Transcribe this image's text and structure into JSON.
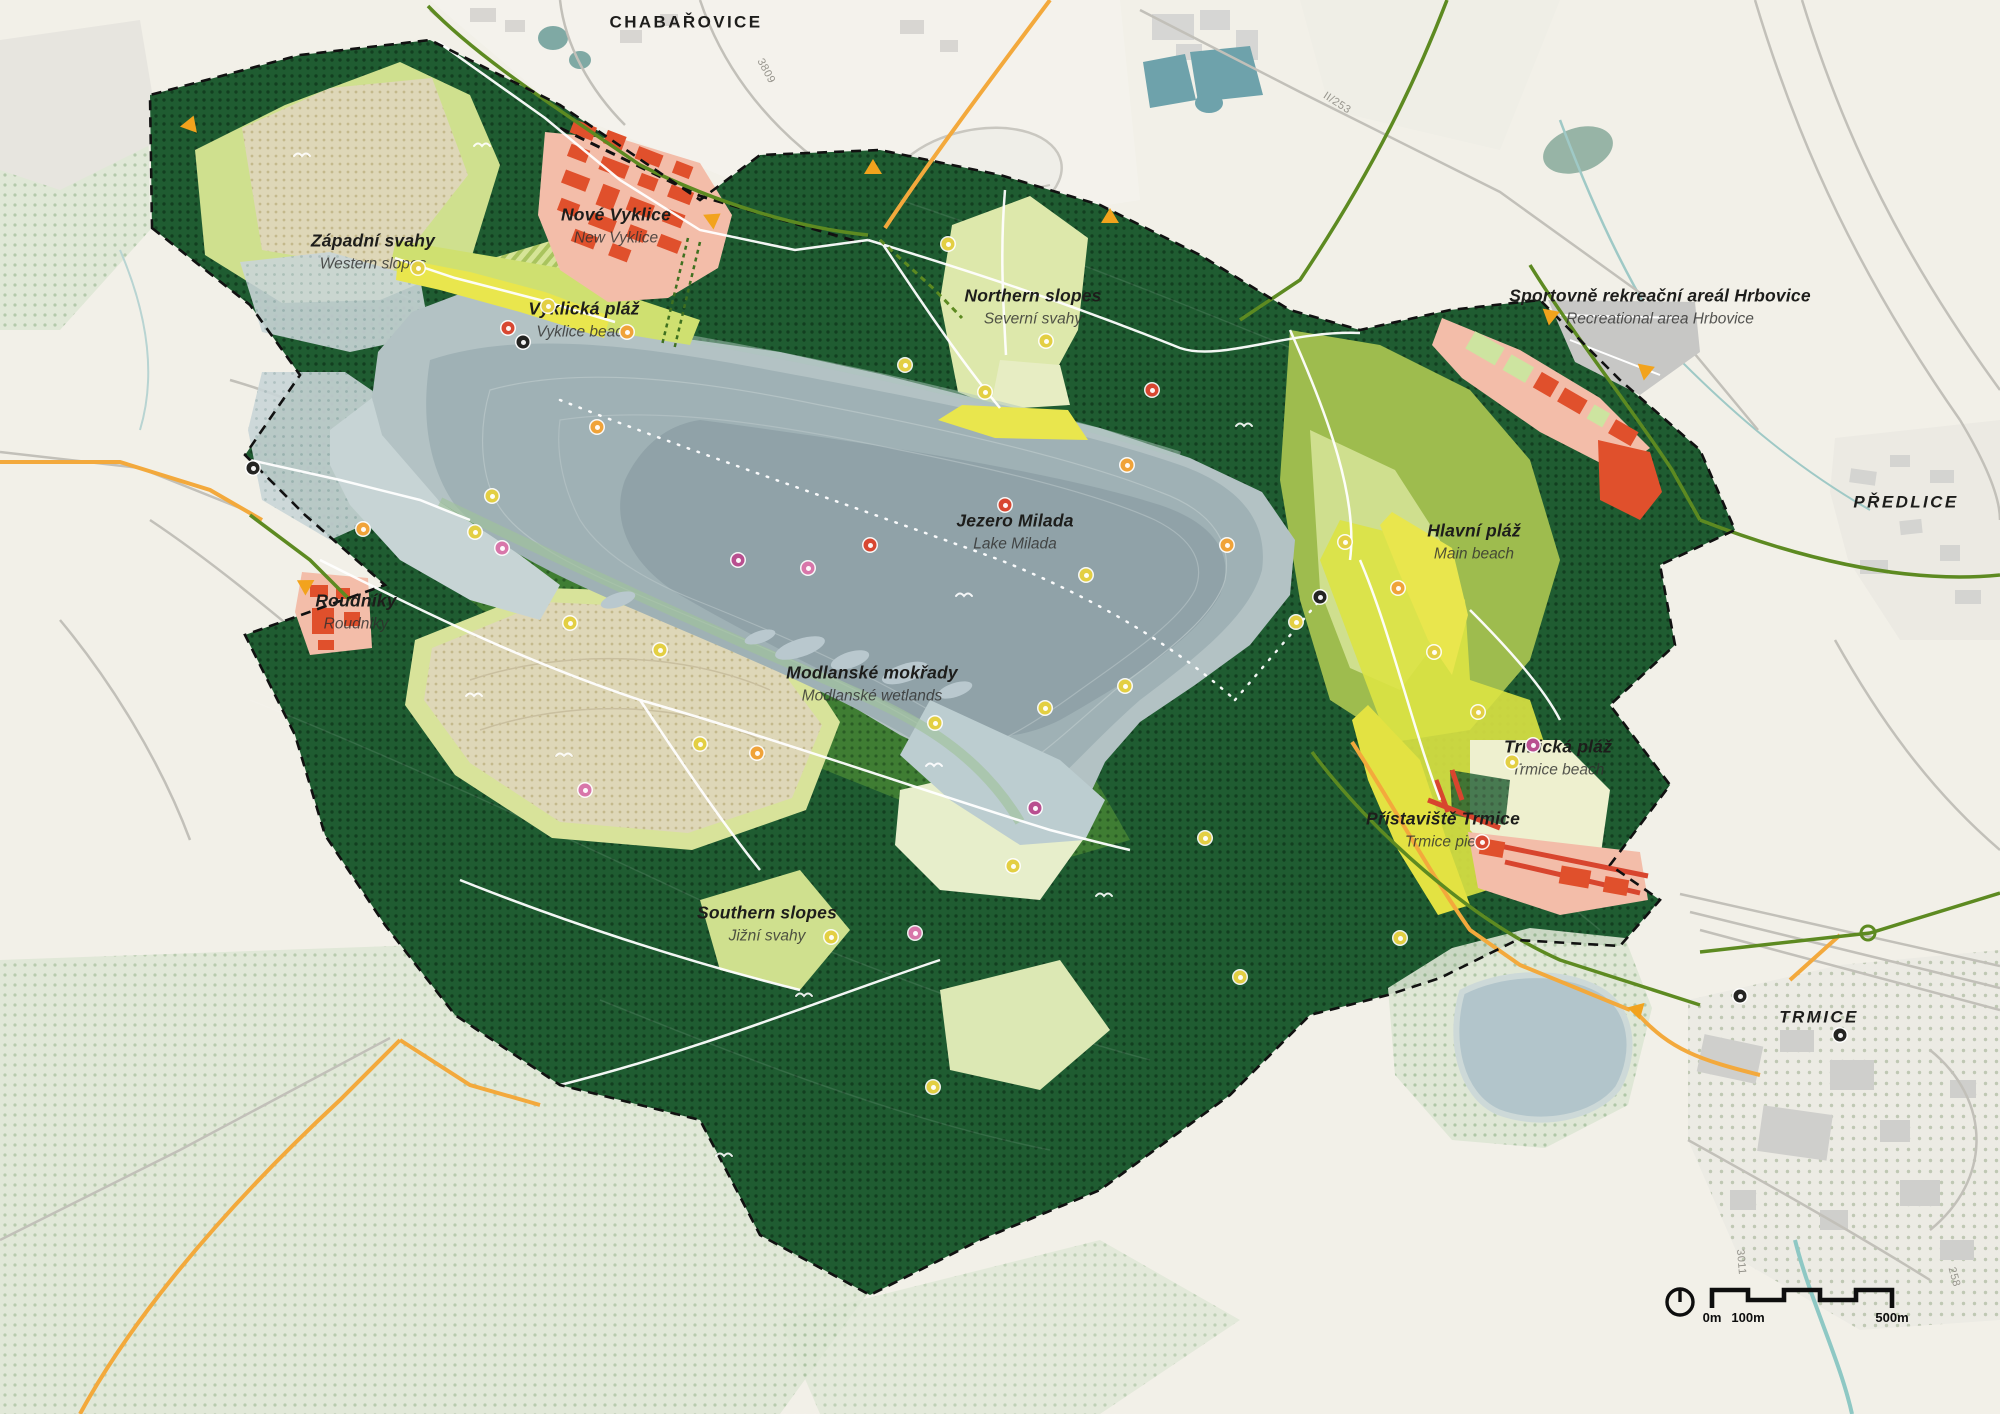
{
  "map": {
    "title": "Jezero Milada — landscape master plan",
    "labels": [
      {
        "id": "chabarovice",
        "primary": "CHABAŘOVICE",
        "secondary": "",
        "x": 686,
        "y": 22,
        "kind": "town",
        "upright": true
      },
      {
        "id": "predlice",
        "primary": "PŘEDLICE",
        "secondary": "",
        "x": 1906,
        "y": 502,
        "kind": "town"
      },
      {
        "id": "trmice",
        "primary": "TRMICE",
        "secondary": "",
        "x": 1819,
        "y": 1017,
        "kind": "town"
      },
      {
        "id": "zapadni-svahy",
        "primary": "Západní svahy",
        "secondary": "Western slopes",
        "x": 373,
        "y": 252
      },
      {
        "id": "nove-vyklice",
        "primary": "Nové Vyklice",
        "secondary": "New Vyklice",
        "x": 616,
        "y": 226
      },
      {
        "id": "vyklicka-plaz",
        "primary": "Vyklická pláž",
        "secondary": "Vyklice beach",
        "x": 584,
        "y": 320
      },
      {
        "id": "northern-slopes",
        "primary": "Northern slopes",
        "secondary": "Severní svahy",
        "x": 1033,
        "y": 307
      },
      {
        "id": "jezero-milada",
        "primary": "Jezero Milada",
        "secondary": "Lake Milada",
        "x": 1015,
        "y": 532
      },
      {
        "id": "hrbovice",
        "primary": "Sportovně rekreační areál Hrbovice",
        "secondary": "Recreational area Hrbovice",
        "x": 1660,
        "y": 307
      },
      {
        "id": "hlavni-plaz",
        "primary": "Hlavní pláž",
        "secondary": "Main beach",
        "x": 1474,
        "y": 542
      },
      {
        "id": "modlanske-mokrady",
        "primary": "Modlanské mokřady",
        "secondary": "Modlanské wetlands",
        "x": 872,
        "y": 684
      },
      {
        "id": "trmicka-plaz",
        "primary": "Trmická pláž",
        "secondary": "Trmice beach",
        "x": 1558,
        "y": 758
      },
      {
        "id": "pristaviste-trmice",
        "primary": "Přístaviště Trmice",
        "secondary": "Trmice pier",
        "x": 1443,
        "y": 830
      },
      {
        "id": "southern-slopes",
        "primary": "Southern slopes",
        "secondary": "Jižní svahy",
        "x": 767,
        "y": 924
      },
      {
        "id": "roudniky",
        "primary": "Roudníky",
        "secondary": "Roudniky",
        "x": 356,
        "y": 612
      }
    ],
    "road_refs": [
      {
        "t": "II/253",
        "x": 1337,
        "y": 103,
        "r": 33
      },
      {
        "t": "3809",
        "x": 766,
        "y": 71,
        "r": 62
      },
      {
        "t": "3011",
        "x": 1741,
        "y": 1262,
        "r": 85
      },
      {
        "t": "258",
        "x": 1954,
        "y": 1277,
        "r": 75
      }
    ],
    "icons": [
      {
        "x": 418,
        "y": 268,
        "c": "y"
      },
      {
        "x": 548,
        "y": 306,
        "c": "y"
      },
      {
        "x": 627,
        "y": 332,
        "c": "o"
      },
      {
        "x": 523,
        "y": 342,
        "c": "k"
      },
      {
        "x": 508,
        "y": 328,
        "c": "r"
      },
      {
        "x": 597,
        "y": 427,
        "c": "o"
      },
      {
        "x": 492,
        "y": 496,
        "c": "y"
      },
      {
        "x": 475,
        "y": 532,
        "c": "y"
      },
      {
        "x": 502,
        "y": 548,
        "c": "p"
      },
      {
        "x": 570,
        "y": 623,
        "c": "y"
      },
      {
        "x": 700,
        "y": 744,
        "c": "y"
      },
      {
        "x": 757,
        "y": 753,
        "c": "o"
      },
      {
        "x": 935,
        "y": 723,
        "c": "y"
      },
      {
        "x": 1045,
        "y": 708,
        "c": "y"
      },
      {
        "x": 1125,
        "y": 686,
        "c": "y"
      },
      {
        "x": 905,
        "y": 365,
        "c": "y"
      },
      {
        "x": 948,
        "y": 244,
        "c": "y"
      },
      {
        "x": 985,
        "y": 392,
        "c": "y"
      },
      {
        "x": 1046,
        "y": 341,
        "c": "y"
      },
      {
        "x": 1127,
        "y": 465,
        "c": "o"
      },
      {
        "x": 1152,
        "y": 390,
        "c": "r"
      },
      {
        "x": 1227,
        "y": 545,
        "c": "o"
      },
      {
        "x": 1296,
        "y": 622,
        "c": "y"
      },
      {
        "x": 1345,
        "y": 542,
        "c": "y"
      },
      {
        "x": 1398,
        "y": 588,
        "c": "o"
      },
      {
        "x": 1434,
        "y": 652,
        "c": "y"
      },
      {
        "x": 1478,
        "y": 712,
        "c": "y"
      },
      {
        "x": 1512,
        "y": 762,
        "c": "y"
      },
      {
        "x": 1533,
        "y": 745,
        "c": "m"
      },
      {
        "x": 1240,
        "y": 977,
        "c": "y"
      },
      {
        "x": 1400,
        "y": 938,
        "c": "y"
      },
      {
        "x": 1013,
        "y": 866,
        "c": "y"
      },
      {
        "x": 933,
        "y": 1087,
        "c": "y"
      },
      {
        "x": 831,
        "y": 937,
        "c": "y"
      },
      {
        "x": 1086,
        "y": 575,
        "c": "y"
      },
      {
        "x": 738,
        "y": 560,
        "c": "m"
      },
      {
        "x": 808,
        "y": 568,
        "c": "p"
      },
      {
        "x": 1035,
        "y": 808,
        "c": "m"
      },
      {
        "x": 870,
        "y": 545,
        "c": "r"
      },
      {
        "x": 1005,
        "y": 505,
        "c": "r"
      },
      {
        "x": 1482,
        "y": 842,
        "c": "r"
      },
      {
        "x": 1320,
        "y": 597,
        "c": "k"
      },
      {
        "x": 363,
        "y": 529,
        "c": "o"
      },
      {
        "x": 253,
        "y": 468,
        "c": "k"
      },
      {
        "x": 1740,
        "y": 996,
        "c": "k"
      },
      {
        "x": 1840,
        "y": 1035,
        "c": "k"
      },
      {
        "x": 1205,
        "y": 838,
        "c": "y"
      },
      {
        "x": 915,
        "y": 933,
        "c": "p"
      },
      {
        "x": 585,
        "y": 790,
        "c": "p"
      },
      {
        "x": 660,
        "y": 650,
        "c": "y"
      }
    ],
    "entrances": [
      {
        "x": 190,
        "y": 128,
        "r": 200
      },
      {
        "x": 712,
        "y": 222,
        "r": 235
      },
      {
        "x": 873,
        "y": 172,
        "r": 180
      },
      {
        "x": 1110,
        "y": 221,
        "r": 180
      },
      {
        "x": 1550,
        "y": 318,
        "r": 250
      },
      {
        "x": 1645,
        "y": 373,
        "r": 250
      },
      {
        "x": 306,
        "y": 588,
        "r": 120
      },
      {
        "x": 1637,
        "y": 1012,
        "r": 345
      }
    ]
  },
  "scalebar": {
    "zero": "0m",
    "hundred": "100m",
    "fivehundred": "500m"
  },
  "colors": {
    "lake": "#a3b4b8",
    "forest": "#215e33",
    "meadow": "#cfe08e",
    "beach": "#e9e64d",
    "development": "#f3bda9",
    "building": "#e0502c",
    "route_green": "#5d8a21",
    "road_orange": "#f3a93c",
    "boundary": "#111111"
  }
}
